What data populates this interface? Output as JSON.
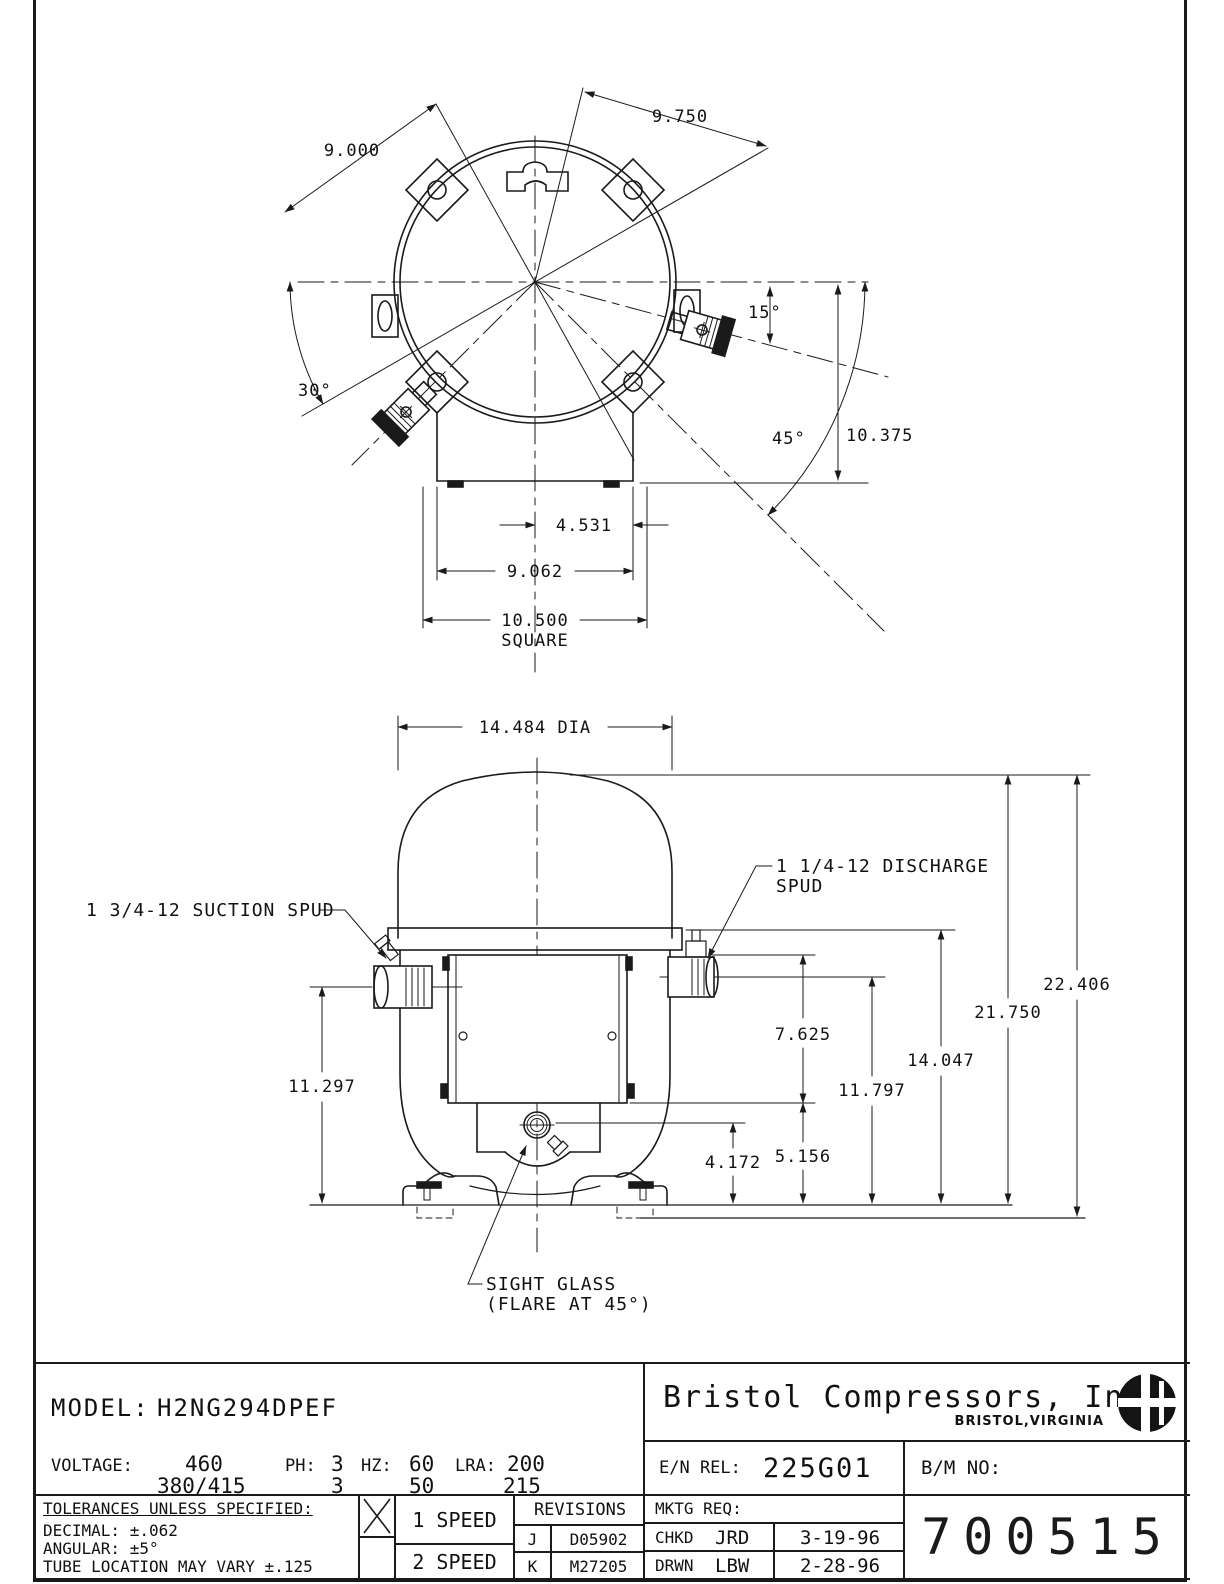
{
  "top_view": {
    "dims": {
      "d9000": "9.000",
      "d9750": "9.750",
      "a30": "30°",
      "a15": "15°",
      "a45": "45°",
      "d10375": "10.375",
      "d4531": "4.531",
      "d9062": "9.062",
      "d10500": "10.500",
      "square": "SQUARE"
    }
  },
  "front_view": {
    "dims": {
      "dia": "14.484 DIA",
      "d11297": "11.297",
      "d7625": "7.625",
      "d5156": "5.156",
      "d4172": "4.172",
      "d11797": "11.797",
      "d14047": "14.047",
      "d21750": "21.750",
      "d22406": "22.406"
    },
    "labels": {
      "suction": "1 3/4-12 SUCTION SPUD",
      "discharge_1": "1 1/4-12 DISCHARGE",
      "discharge_2": "SPUD",
      "sight_1": "SIGHT GLASS",
      "sight_2": "(FLARE AT 45°)"
    }
  },
  "title_block": {
    "model_label": "MODEL:",
    "model_value": "H2NG294DPEF",
    "voltage_label": "VOLTAGE:",
    "ph_label": "PH:",
    "hz_label": "HZ:",
    "lra_label": "LRA:",
    "row1": {
      "volts": "460",
      "ph": "3",
      "hz": "60",
      "lra": "200"
    },
    "row2": {
      "volts": "380/415",
      "ph": "3",
      "hz": "50",
      "lra": "215"
    },
    "company": "Bristol Compressors, Inc",
    "company_location": "BRISTOL,VIRGINIA",
    "en_rel_label": "E/N REL:",
    "en_rel_value": "225G01",
    "bm_no_label": "B/M NO:",
    "drawing_number": "700515",
    "tolerances": {
      "heading": "TOLERANCES UNLESS SPECIFIED:",
      "decimal": "DECIMAL: ±.062",
      "angular": "ANGULAR: ±5°",
      "tube": "TUBE LOCATION MAY VARY ±.125"
    },
    "speed": {
      "one": "1 SPEED",
      "two": "2 SPEED",
      "selected": "1 SPEED"
    },
    "revisions": {
      "heading": "REVISIONS",
      "rows": [
        {
          "rev": "J",
          "num": "D05902"
        },
        {
          "rev": "K",
          "num": "M27205"
        }
      ]
    },
    "mktg": {
      "label": "MKTG REQ:",
      "chkd_label": "CHKD",
      "chkd_by": "JRD",
      "chkd_date": "3-19-96",
      "drwn_label": "DRWN",
      "drwn_by": "LBW",
      "drwn_date": "2-28-96"
    }
  }
}
